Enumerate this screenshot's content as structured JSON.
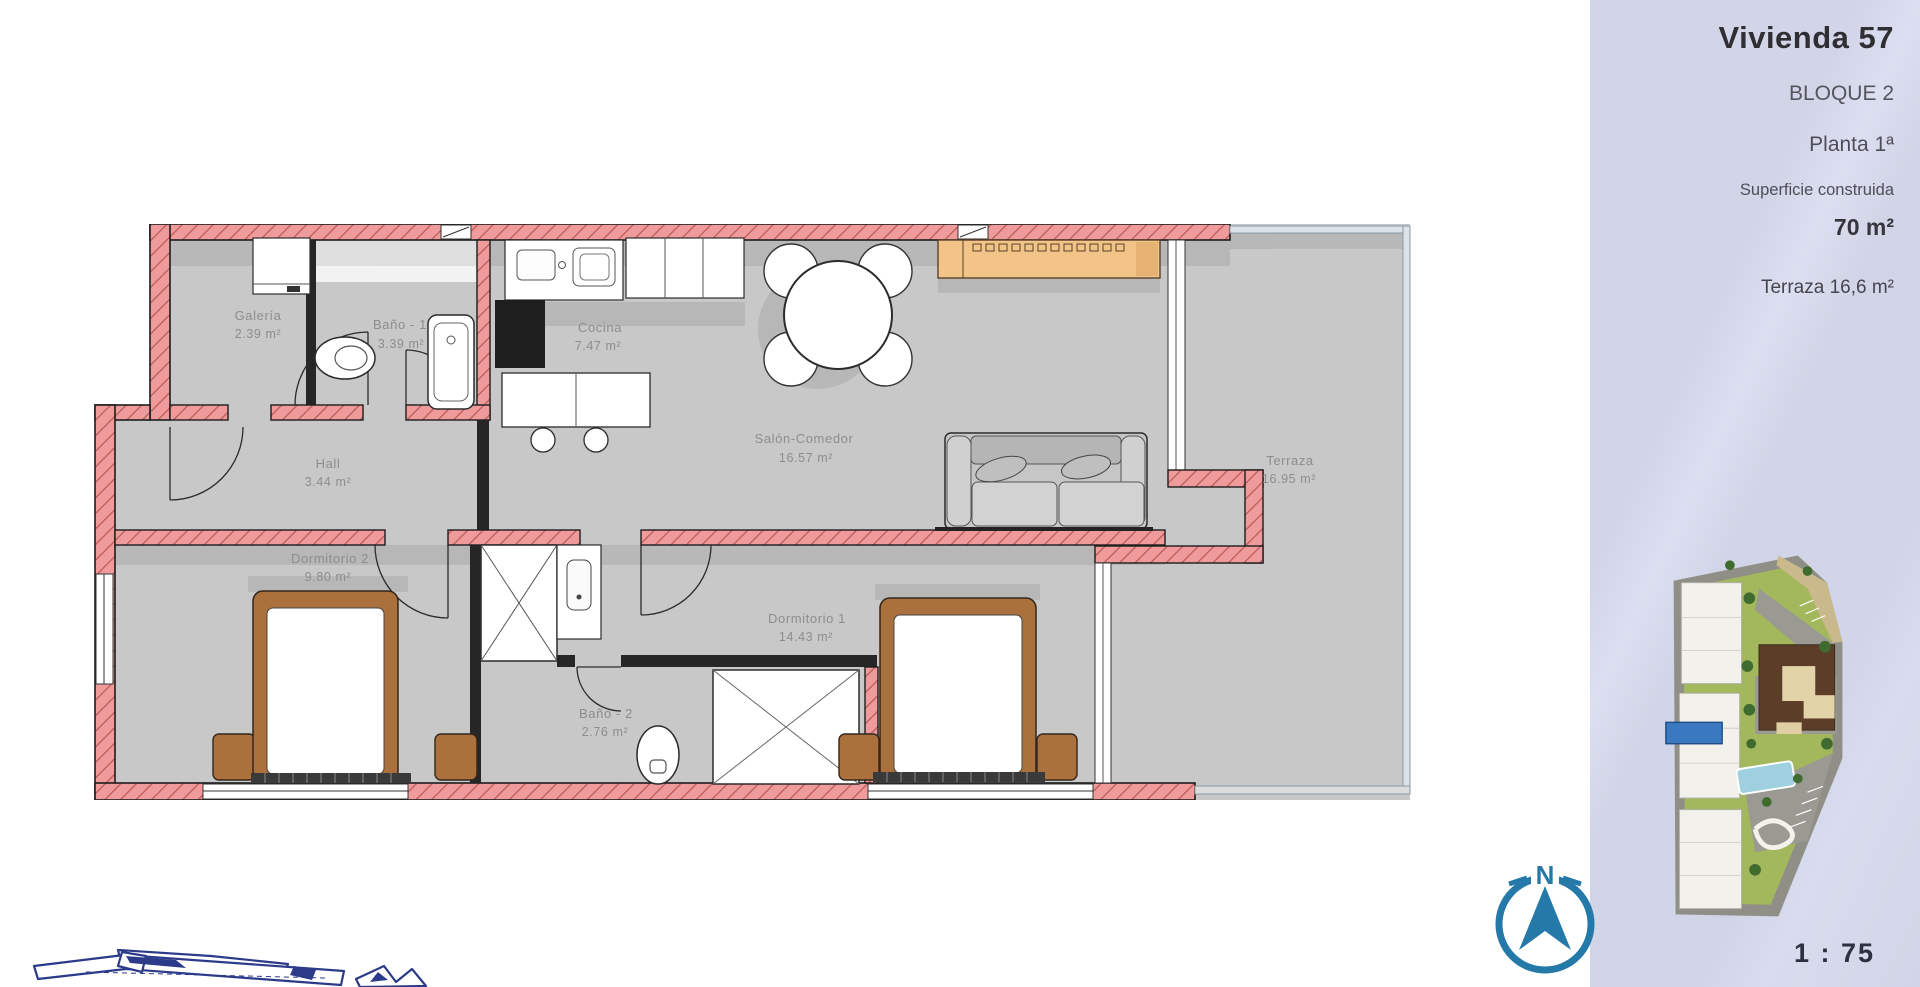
{
  "page": {
    "background": "#ffffff"
  },
  "sidebar": {
    "background": "#d3d5e8",
    "title": "Vivienda 57",
    "block": "BLOQUE 2",
    "floor": "Planta 1ª",
    "surface_label": "Superficie construida",
    "surface_value": "70 m²",
    "terrace_label": "Terraza 16,6 m²",
    "scale_label": "1 : 75"
  },
  "compass": {
    "north": "N",
    "color": "#2579a8"
  },
  "floor_plan": {
    "wall_color": "#ef9b9b",
    "floor_color": "#c8c8c8",
    "rooms": [
      {
        "name": "Galería",
        "area": "2.39 m²"
      },
      {
        "name": "Baño - 1",
        "area": "3.39 m²"
      },
      {
        "name": "Cocina",
        "area": "7.47 m²"
      },
      {
        "name": "Salón-Comedor",
        "area": "16.57 m²"
      },
      {
        "name": "Hall",
        "area": "3.44 m²"
      },
      {
        "name": "Dormitorio 2",
        "area": "9.80 m²"
      },
      {
        "name": "Dormitorio 1",
        "area": "14.43 m²"
      },
      {
        "name": "Baño - 2",
        "area": "2.76 m²"
      },
      {
        "name": "Terraza",
        "area": "16.95 m²"
      }
    ]
  },
  "site_plan": {
    "marker_color": "#3a78bf"
  }
}
